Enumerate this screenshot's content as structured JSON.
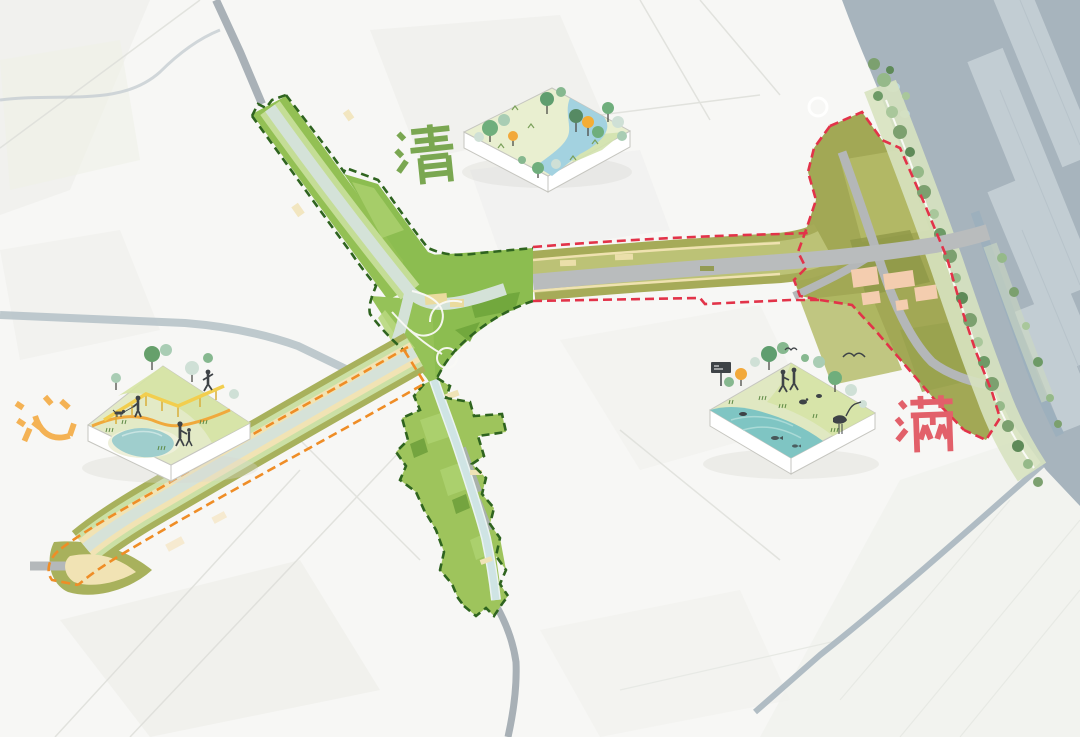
{
  "labels": {
    "qing": {
      "text": "清",
      "color": "#7aa751",
      "meaning": "clear"
    },
    "qin": {
      "text": "沁",
      "color": "#f4b254",
      "meaning": "refresh"
    },
    "man": {
      "text": "满",
      "color": "#e2606a",
      "meaning": "full"
    }
  },
  "map": {
    "background": "#f7f7f5",
    "sea": "#a7b4bd",
    "aquaculture_strip": "#c6d0d6",
    "corridor_green": "#8fbe52",
    "corridor_light_green": "#c4dd96",
    "river_mint": "#d4e2d8",
    "canal_blue": "#cfe4e4",
    "olive_band": "#a6ab58",
    "olive_light": "#bcc276",
    "cream_path": "#f1e3b4",
    "road_gray": "#b9bcbd",
    "building_pink": "#f4cdaf",
    "coast_tree_green": "#7ca06f",
    "boundary_green_dash": "#2f641f",
    "boundary_red_dash": "#e23349",
    "boundary_orange_dash": "#ef8d26"
  },
  "dioramas": {
    "river_park": {
      "label": "清",
      "features": [
        "winding-river",
        "lawn",
        "mixed-trees",
        "orange-tree",
        "grass-marks"
      ]
    },
    "recreation_park": {
      "label": "沁",
      "features": [
        "pond",
        "orange-trail",
        "yellow-boardwalk",
        "dog-walker",
        "runner",
        "parent-and-child",
        "trees"
      ]
    },
    "wetland_park": {
      "label": "满",
      "features": [
        "lake",
        "heron",
        "flying-bird",
        "fish",
        "otter",
        "wayfinding-sign",
        "two-visitors",
        "orange-tree",
        "reeds"
      ]
    }
  }
}
